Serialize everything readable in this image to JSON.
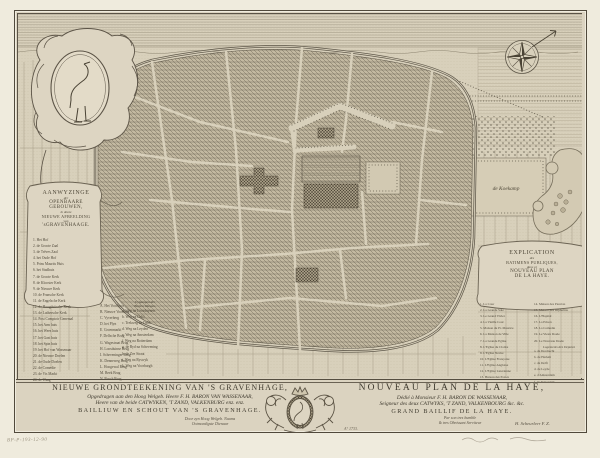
{
  "map": {
    "koekamp_label": "de Koekamp"
  },
  "cartouche_nl": {
    "title": {
      "l1": "AANWYZINGE",
      "l2": "der",
      "l3": "OPENBAARE",
      "l4": "GEBOUWEN,",
      "l5": "in deeze",
      "l6": "NIEUWE AFBEELDING",
      "l7": "van",
      "l8": "'sGRAVENHAAGE."
    },
    "items": [
      "1. Het Hof",
      "2. de Groote Zaal",
      "3. de Trêves Zaal",
      "4. het Oude Hof",
      "5. Prins Maurits Huis",
      "6. het Stadhuis",
      "7. de Groote Kerk",
      "8. de Klooster Kerk",
      "9. de Nieuwe Kerk",
      "10. de Fransche Kerk",
      "11. de Engelsche Kerk",
      "12. de Hoogduitsche Kerk",
      "13. de Luthersche Kerk",
      "14. Post Comptoir Generaal",
      "15. het Arm huis",
      "16. het Wees huis",
      "17. het Gast huis",
      "18. het Spin huis",
      "19. het Hof van Wassenaar",
      "20. de Nieuwe Doelen",
      "21. de Oude Doelen",
      "22. de Comedie",
      "23. de Vis Markt",
      "24. de Waag"
    ]
  },
  "legend_letters": {
    "items": [
      "A. Het Voorhout",
      "B. Nieuwe Voorhout",
      "C. Vyverberg",
      "D. het Plyn",
      "E. Groenmarkt",
      "F. Delfsche Brug",
      "G. Wagestraat Brug",
      "H. Loosduinse Brug",
      "I. Scheveninger Brug",
      "K. Denneweg Brug",
      "L. Hoogewal Brug",
      "M. Beek Brug",
      "N. Bosch Brug"
    ]
  },
  "legend_roads": {
    "header_l1": "Uytgangen der",
    "header_l2": "Buyten Weegen.",
    "items": [
      "a. Weg na Loosduynen",
      "b. Weg na Delft",
      "c. Trekweg na Delft",
      "d. Weg na Leyden",
      "e. Weg na Amsterdam",
      "f. Weg na Rotterdam",
      "g. de Ryd na Schevening",
      "h. de Zee Straat",
      "i. Weg na Ryswyk",
      "k. Weg na Voorburgh"
    ]
  },
  "cartouche_fr": {
    "title": {
      "l1": "EXPLICATION",
      "l2": "des",
      "l3": "BATIMENS PUBLIQUES,",
      "l4": "dans ce",
      "l5": "NOUVEAU PLAN",
      "l6": "DE LA HAYE."
    },
    "col1": [
      "1. La Cour",
      "2. La Grande Sale",
      "3. Le Grand Vivier",
      "4. La Vieille Cour",
      "5. Maison du Pr. Maurice",
      "6. La Maison de Ville",
      "7. La Grande Eglise",
      "8. L'Eglise du Cloitre",
      "9. L'Eglise Neuve",
      "10. L'Eglise Françoise",
      "11. L'Eglise Angloise",
      "12. L'Eglise Luterienne",
      "13. Bureau des Postes"
    ],
    "col2": [
      "14. Maison des Pauvres",
      "15. Maison des Orphelins",
      "16. L'Hopital",
      "17. La Prison",
      "18. La Comedie",
      "19. Le Vieux Doele",
      "20. Le Nouveau Doele"
    ],
    "sub_header": "Logements des Deputez",
    "sub_items": [
      "a. de Dordrecht",
      "b. de Harlem",
      "c. de Delft",
      "d. de Leyde",
      "e. d'Amsterdam",
      "f. de Rotterdam"
    ]
  },
  "title_nl": {
    "l1": "NIEUWE GRONDTEEKENING VAN 'S GRAVENHAGE,",
    "l2": "Opgedragen aan den Hoog Welgeb. Heere F. H. BARON VAN WASSENAAR,",
    "l3": "Heere van de beide CATWYKEN, 'T ZAND, VALKENBURG enz. enz.",
    "l4": "BAILLIUW EN SCHOUT VAN 'S GRAVENHAGE.",
    "dedication_l1": "Door zyn Hoog Welgeb. Naams",
    "dedication_l2": "Ootmoedigste Dienaar"
  },
  "title_fr": {
    "l1": "NOUVEAU PLAN DE LA HAYE,",
    "l2": "Dédié à Monsieur F. H. BARON DE WASSENAAR,",
    "l3": "Seigneur des deux CATWYKS, 'T ZAND, VALKENBOURG &c. &c.",
    "l4": "GRAND BAILLIF DE LA HAYE.",
    "dedication_l1": "Par son tres humble",
    "dedication_l2": "& tres Obeissant Serviteur",
    "signature": "H. Scheurleer F. Z.",
    "year": "A° 1733."
  },
  "margin": {
    "inscription_left": "BP-P-193-12-90"
  },
  "colors": {
    "paper_margin": "#efebdd",
    "paper_plate": "#dbd3c0",
    "ink_dark": "#4a4335",
    "ink_light": "#8a8270",
    "pencil": "#9a927f"
  }
}
